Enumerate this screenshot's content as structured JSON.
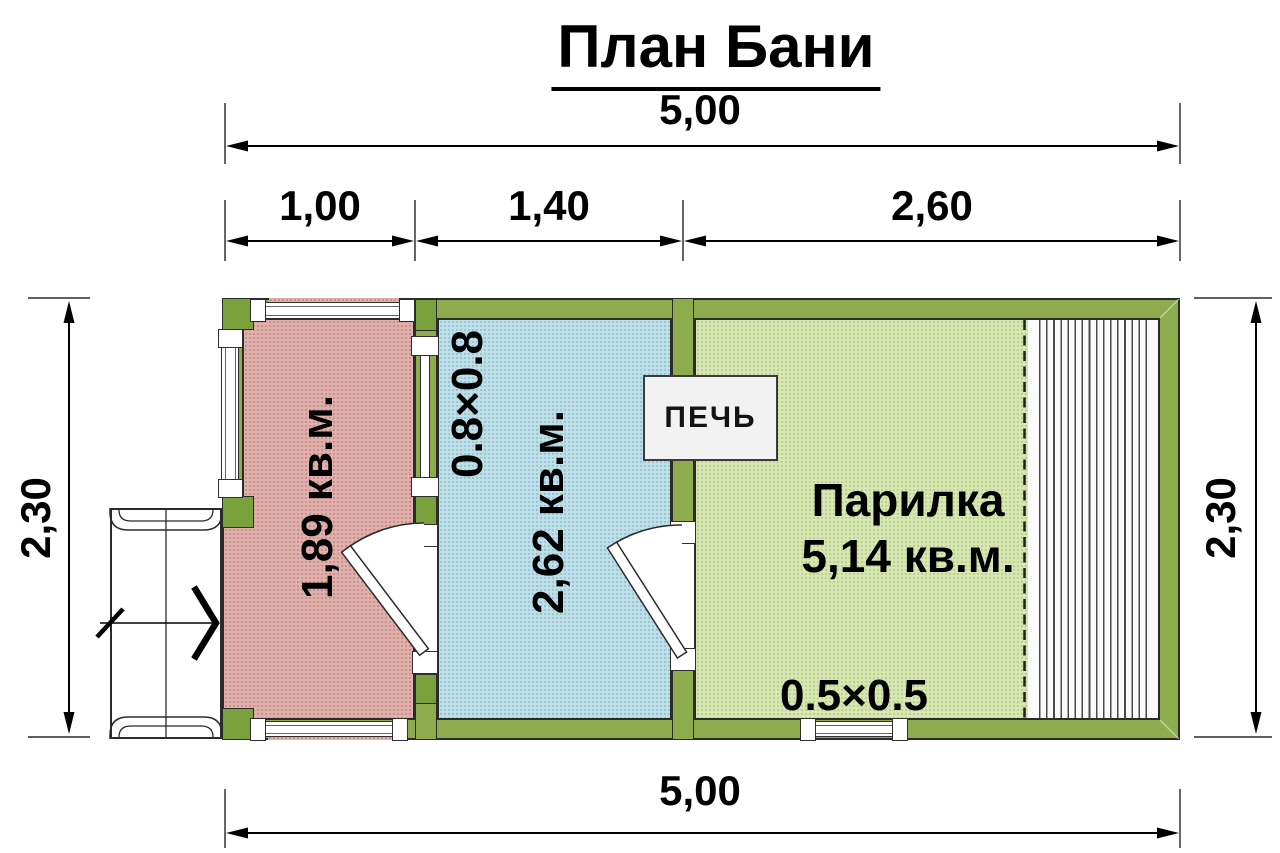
{
  "title": "План Бани",
  "dimensions": {
    "top_total": "5,00",
    "segments": [
      "1,00",
      "1,40",
      "2,60"
    ],
    "left_height": "2,30",
    "right_height": "2,30",
    "bottom_total": "5,00"
  },
  "rooms": {
    "entry": {
      "area": "1,89 кв.м."
    },
    "washing": {
      "size": "0.8×0.8",
      "area": "2,62 кв.м."
    },
    "steam": {
      "name": "Парилка",
      "area": "5,14 кв.м.",
      "window_size": "0.5×0.5"
    }
  },
  "stove": {
    "label": "ПЕЧЬ"
  },
  "colors": {
    "wall": "#8cac4e",
    "post": "#7aa23c",
    "entry_fill": "#e0b0ac",
    "washing_fill": "#bedfe8",
    "steam_fill": "#d8e6b4",
    "line": "#2b2b2b"
  }
}
